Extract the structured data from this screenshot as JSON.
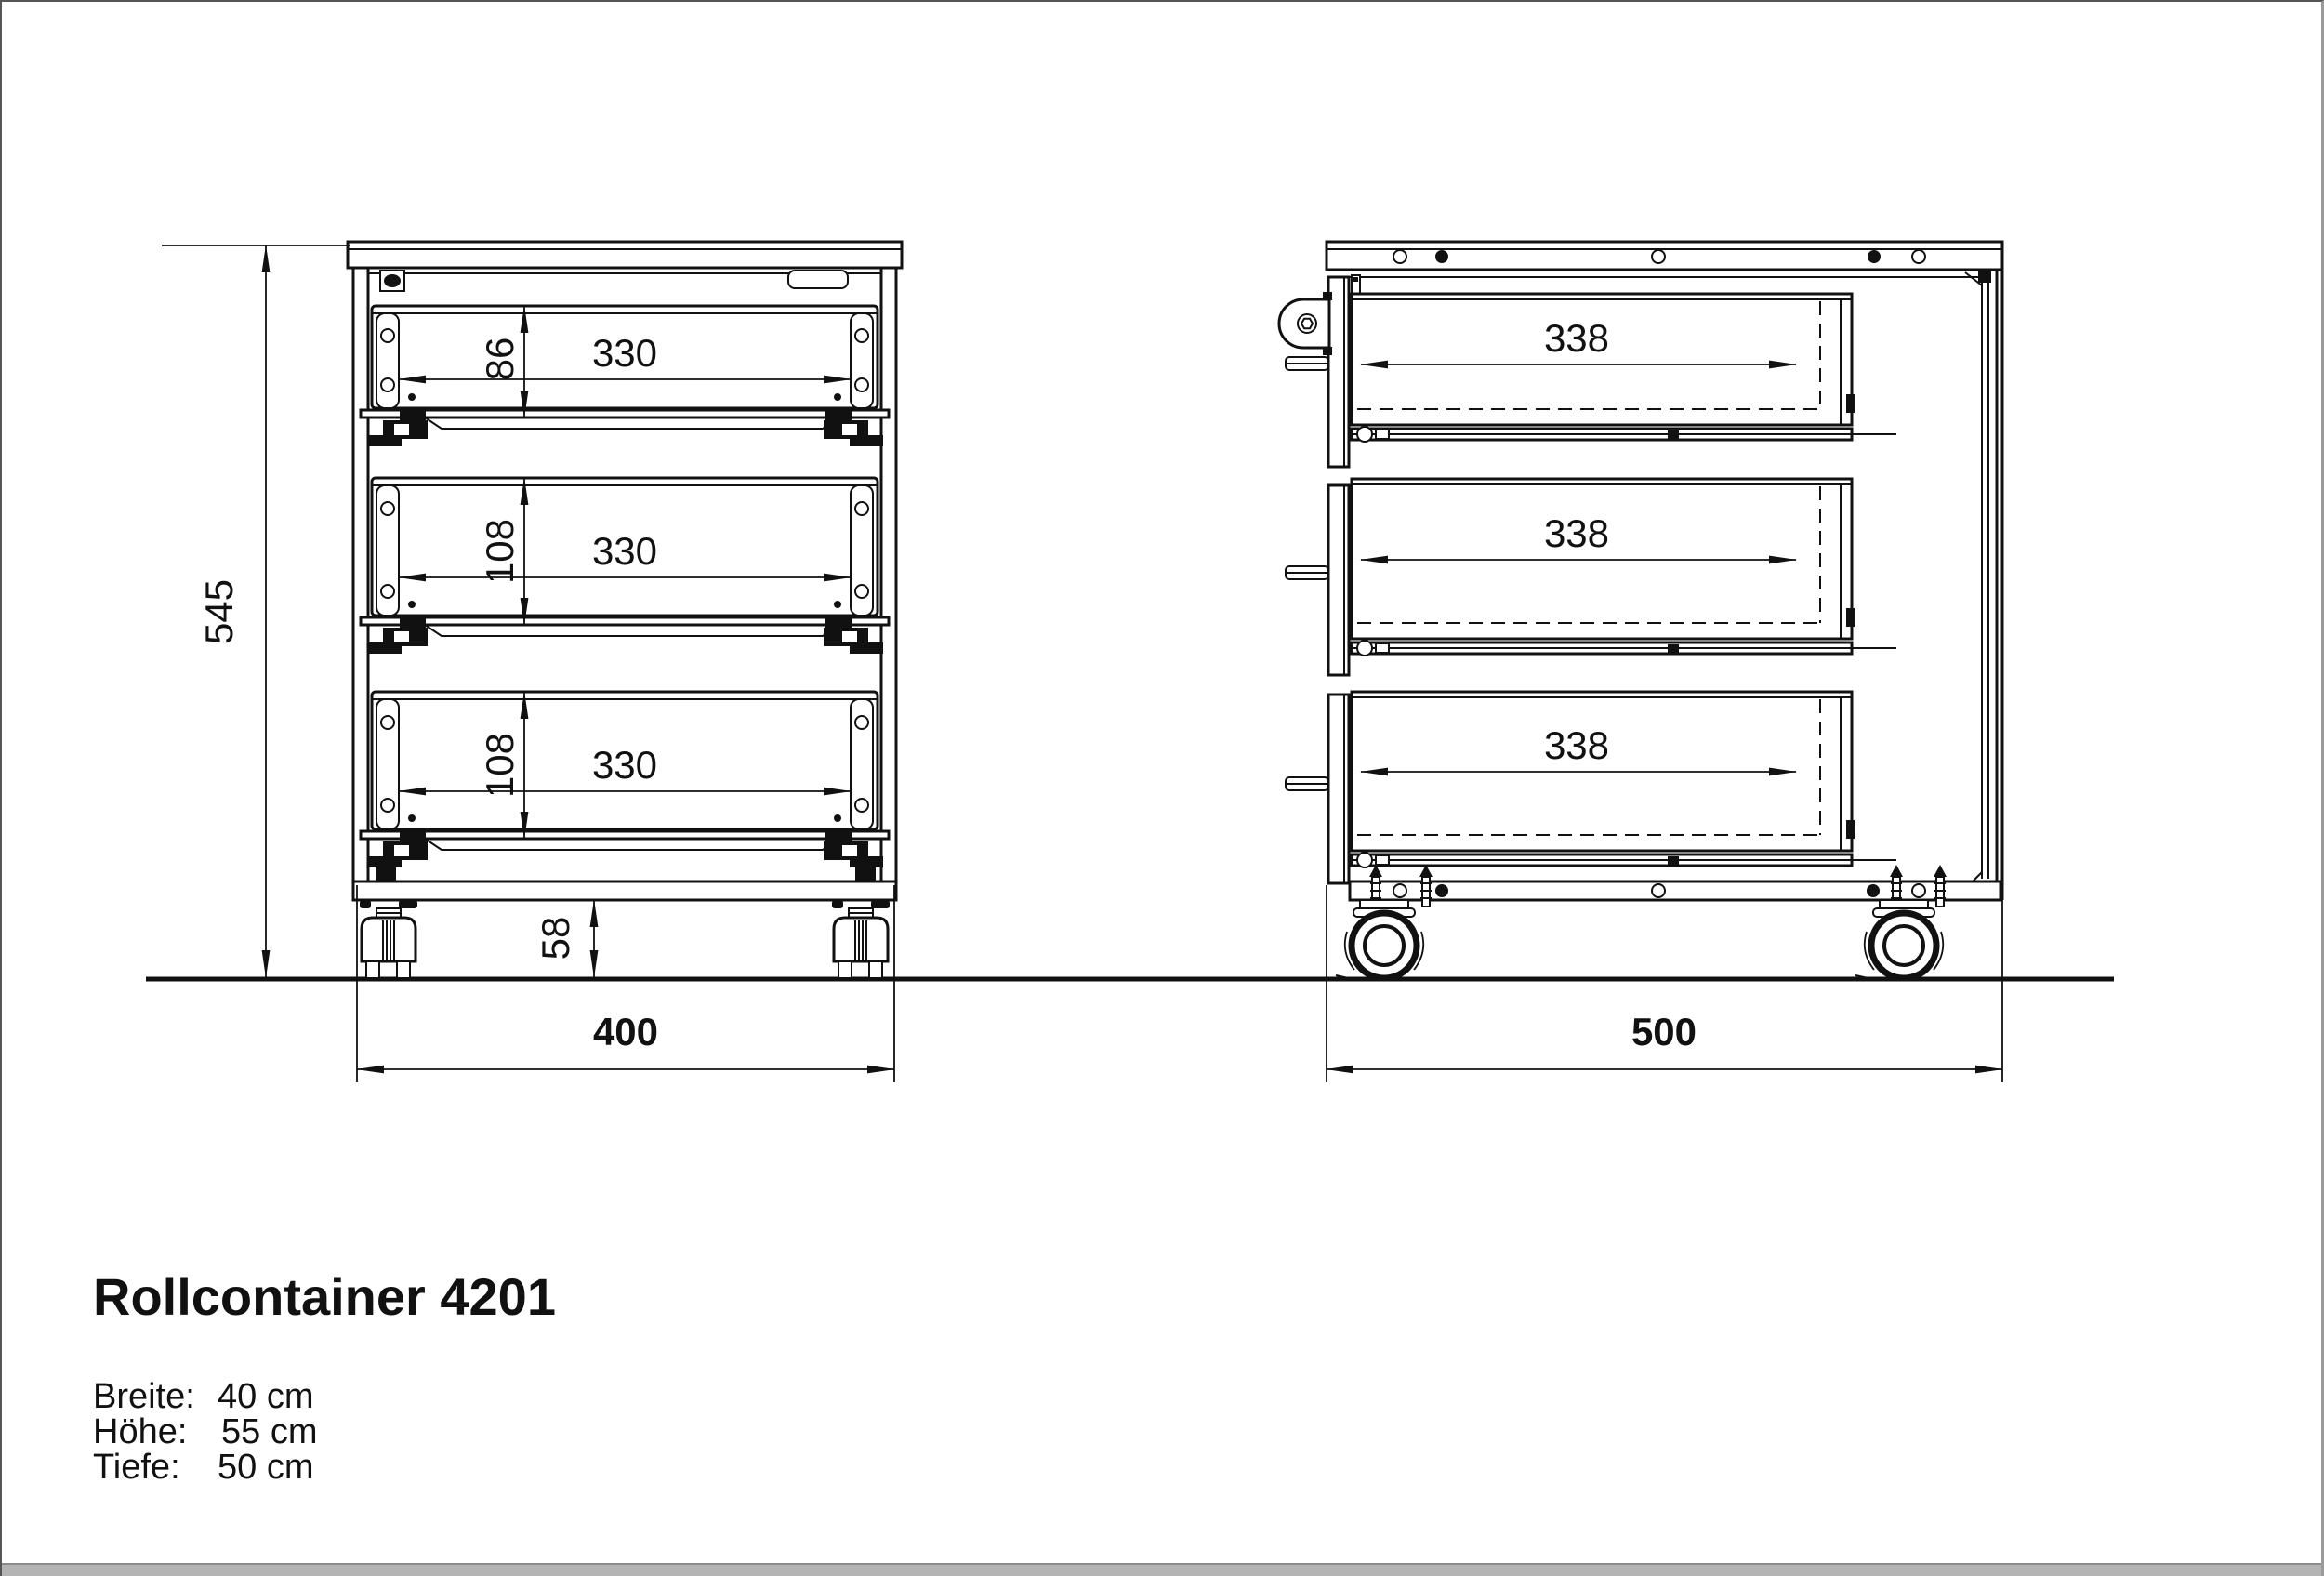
{
  "title": "Rollcontainer 4201",
  "specs": {
    "rows": [
      {
        "label": "Breite:",
        "value": "40 cm"
      },
      {
        "label": "Höhe:",
        "value": "55 cm"
      },
      {
        "label": "Tiefe:",
        "value": "50 cm"
      }
    ]
  },
  "front_view": {
    "overall_height": "545",
    "overall_width": "400",
    "caster_height": "58",
    "drawers": [
      {
        "front_height": "86",
        "opening_width": "330"
      },
      {
        "front_height": "108",
        "opening_width": "330"
      },
      {
        "front_height": "108",
        "opening_width": "330"
      }
    ]
  },
  "side_view": {
    "overall_depth": "500",
    "drawers": [
      {
        "depth": "338"
      },
      {
        "depth": "338"
      },
      {
        "depth": "338"
      }
    ]
  },
  "colors": {
    "line": "#111111",
    "frame": "#8c8c8c",
    "bottom_bar": "#b4b4b4"
  }
}
